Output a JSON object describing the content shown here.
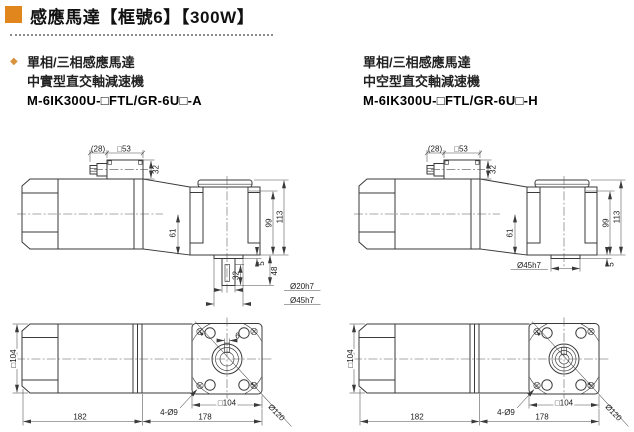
{
  "header": {
    "title": "感應馬達【框號6】【300W】",
    "accent_color": "#E0861C"
  },
  "columns": [
    {
      "line1": "單相/三相感應馬達",
      "line2": "中實型直交軸減速機",
      "model": "M-6IK300U-□FTL/GR-6U□-A",
      "side": {
        "gland": "(28)",
        "box": "□53",
        "box_h": "32",
        "center_face": "61",
        "h_inner": "99",
        "h_total": "113",
        "boss_h": "5",
        "shaft_total": "48",
        "shaft_len": "32",
        "shaft_dia": "Ø20h7",
        "boss_dia": "Ø45h7"
      },
      "bottom": {
        "width": "□104",
        "motor_len": "182",
        "gear_len": "178",
        "holes": "4-Ø9",
        "square": "□104",
        "circle": "Ø120",
        "key": "6"
      }
    },
    {
      "line1": "單相/三相感應馬達",
      "line2": "中空型直交軸減速機",
      "model": "M-6IK300U-□FTL/GR-6U□-H",
      "side": {
        "gland": "(28)",
        "box": "□53",
        "box_h": "32",
        "center_face": "61",
        "h_inner": "99",
        "h_total": "113",
        "boss_dia": "Ø45h7",
        "boss_h": "5"
      },
      "bottom": {
        "width": "□104",
        "motor_len": "182",
        "gear_len": "178",
        "holes": "4-Ø9",
        "square": "□104",
        "circle": "Ø120"
      }
    }
  ]
}
